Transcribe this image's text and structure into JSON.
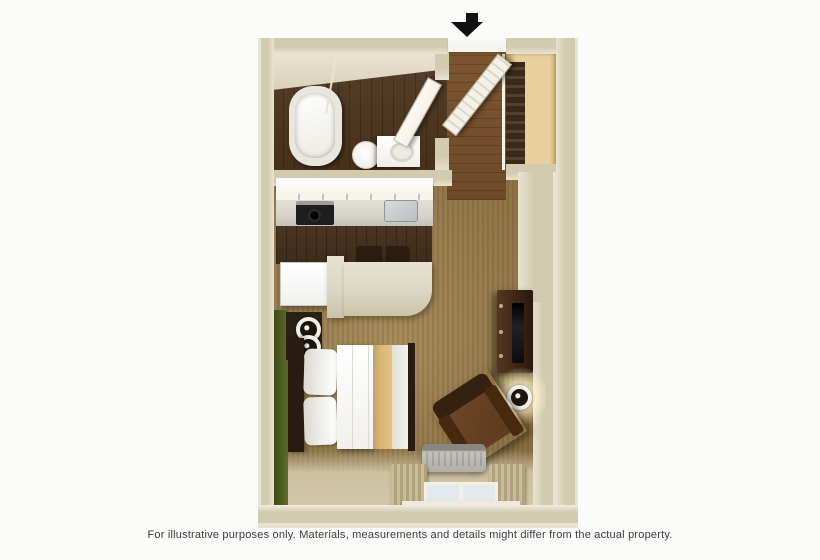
{
  "disclaimer": "For illustrative purposes only.  Materials, measurements and details might differ from the actual property.",
  "entry": {
    "arrow_icon": "down-arrow"
  },
  "legend": {
    "entry_door": "entry door (open)",
    "closet": "closet with shelf and hanging clothes",
    "bathtub": "bathtub",
    "shower_rod": "shower curtain rod",
    "toilet": "toilet",
    "vanity": "vanity sink",
    "bathroom_door": "bathroom door (open)",
    "cabinets": "kitchen upper cabinets",
    "cooktop": "cooktop stove",
    "kitchen_sink": "kitchen sink",
    "refrigerator": "refrigerator",
    "breakfast_bar": "breakfast bar counter",
    "bar_stool": "bar stool",
    "bed": "bed with gold runner",
    "pillow": "pillow",
    "wall_sconce": "wall sconce light",
    "tv_stand": "TV stand dresser",
    "tv": "flat-screen TV",
    "armchair": "armchair",
    "reading_lamp": "lit wall lamp",
    "ac_unit": "AC / heating unit",
    "window": "window",
    "curtain": "curtain panel",
    "green_wall": "green accent wall"
  },
  "colors": {
    "page": "#fbfbfa",
    "wall": "#d3cbb0",
    "wallLight": "#e9e3d1",
    "bathFloor": "#463019",
    "kitchenFloor": "#3e2b1a",
    "hallFloor": "#6e4a28",
    "carpet": "#a2834e",
    "carpetShade": "#8a6d3c",
    "floorLight": "#d2c7a9",
    "greenDark": "#243109",
    "greenLight": "#5d6d2b",
    "closetWood": "#e9cf9b",
    "clothes": "#3a2918",
    "cabinet": "#f6f4ec",
    "counter": "#d7d3ca",
    "peninsula": "#dcd7c3",
    "fridge": "#f0f1ee",
    "stove": "#1e1e1e",
    "sink": "#b9bec0",
    "stool": "#2e1c10",
    "bedLinen": "#f1f0ec",
    "pillow": "#eceae4",
    "bedStripe": "#d8b775",
    "bedFrame": "#2a1b10",
    "dresser": "#3d2514",
    "tv": "#0b0b0b",
    "chair": "#5c3a1d",
    "chairDark": "#36200f",
    "ac": "#b0aea8",
    "curtain": "#c9bc9a",
    "curtainStripe": "#b0a37c",
    "windowGlass": "#e3eaed",
    "doorWhite": "#f4f1e8",
    "glow": "#fff6cf",
    "arrow": "#111111",
    "text": "#3b3b3b"
  }
}
